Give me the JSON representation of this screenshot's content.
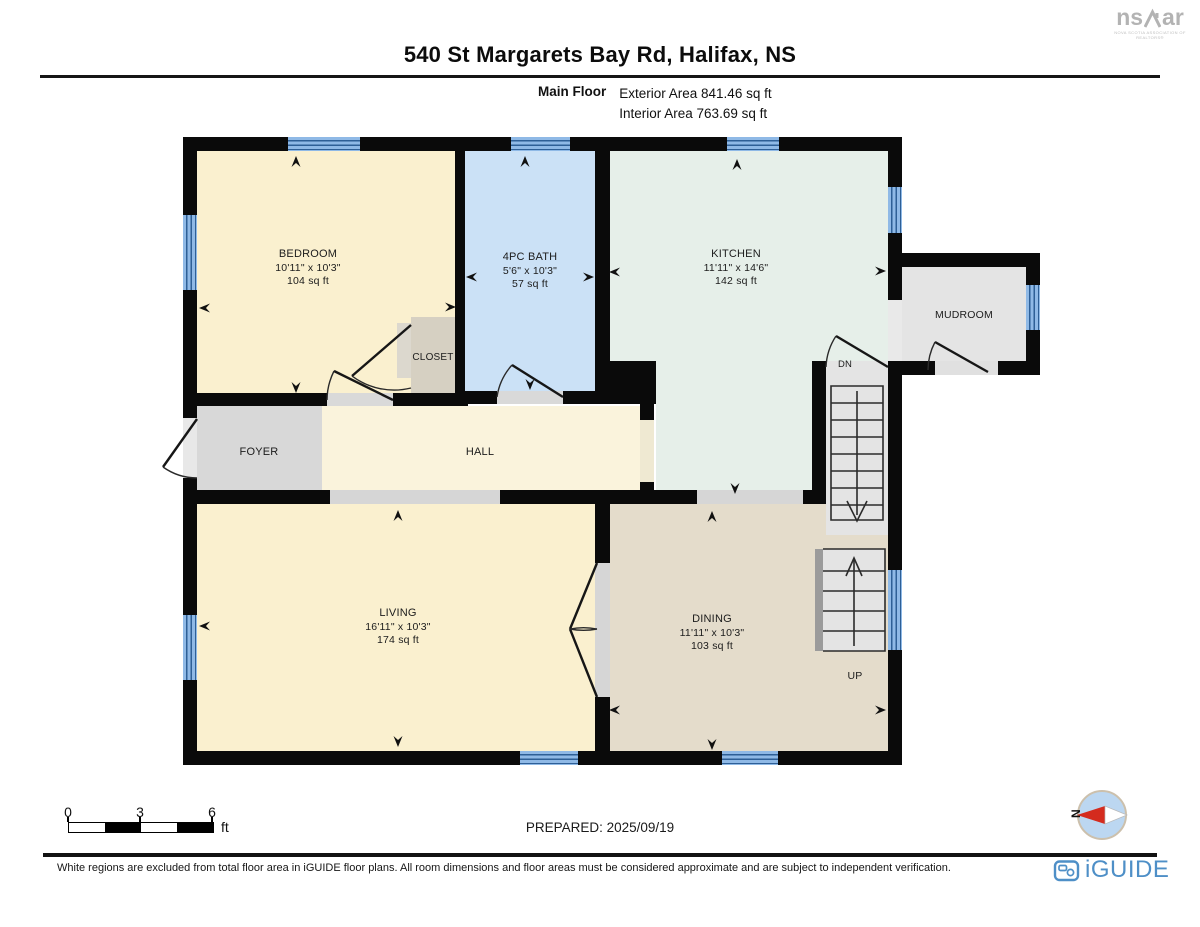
{
  "header": {
    "title": "540 St Margarets Bay Rd, Halifax, NS",
    "floor_label": "Main Floor",
    "exterior_area": "Exterior Area 841.46 sq ft",
    "interior_area": "Interior Area 763.69 sq ft"
  },
  "nsar_logo": {
    "prefix": "ns",
    "suffix": "ar",
    "caption": "NOVA SCOTIA ASSOCIATION OF REALTORS®"
  },
  "plan": {
    "rooms": [
      {
        "name": "BEDROOM",
        "dims": "10'11\" x 10'3\"",
        "area": "104 sq ft"
      },
      {
        "name": "4PC BATH",
        "dims": "5'6\" x 10'3\"",
        "area": "57 sq ft"
      },
      {
        "name": "KITCHEN",
        "dims": "11'11\" x 14'6\"",
        "area": "142 sq ft"
      },
      {
        "name": "MUDROOM"
      },
      {
        "name": "CLOSET"
      },
      {
        "name": "FOYER"
      },
      {
        "name": "HALL"
      },
      {
        "name": "LIVING",
        "dims": "16'11\" x 10'3\"",
        "area": "174 sq ft"
      },
      {
        "name": "DINING",
        "dims": "11'11\" x 10'3\"",
        "area": "103 sq ft"
      }
    ],
    "stairs": {
      "down_label": "DN",
      "up_label": "UP"
    }
  },
  "scale_bar": {
    "ticks": [
      "0",
      "3",
      "6"
    ],
    "unit": "ft"
  },
  "footer": {
    "prepared": "PREPARED: 2025/09/19",
    "disclaimer": "White regions are excluded from total floor area in iGUIDE floor plans. All room dimensions and floor areas must be considered approximate and are subject to independent verification.",
    "brand": "iGUIDE",
    "compass_label": "N"
  },
  "colors": {
    "wall": "#0a0a0a",
    "bedroom": "#faf0cf",
    "bath": "#cbe1f6",
    "kitchen": "#e6efe9",
    "dining": "#e4dccb",
    "mudroom": "#e4e4e4",
    "foyer": "#d8d8d8",
    "hall": "#faf3dc",
    "closet": "#d6d0c2",
    "window": "#8fb9e6",
    "window_line": "#2e5f96",
    "compass_fill": "#bcd7f1",
    "compass_needle": "#d42b1e",
    "brand_blue": "#4e8fc7",
    "nsar_gray": "#b3b3b3"
  }
}
